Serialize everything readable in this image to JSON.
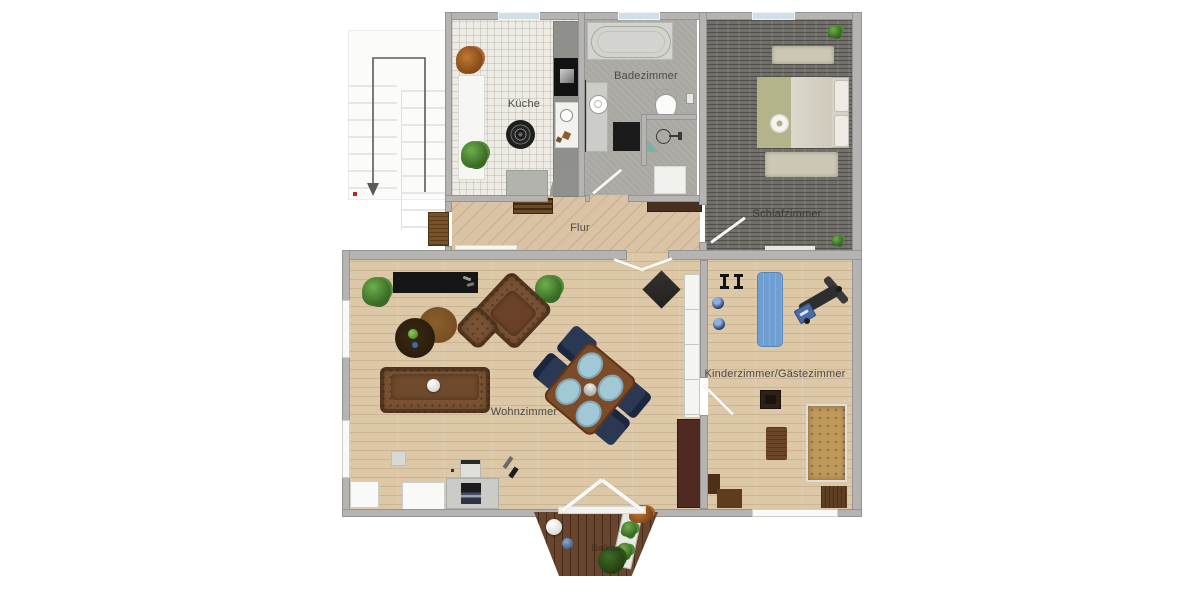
{
  "rooms": {
    "kueche": {
      "label": "Küche"
    },
    "badezimmer": {
      "label": "Badezimmer"
    },
    "schlafzimmer": {
      "label": "Schlafzimmer"
    },
    "flur": {
      "label": "Flur"
    },
    "wohnzimmer": {
      "label": "Wohnzimmer"
    },
    "kinderzimmer": {
      "label": "Kinderzimmer/Gästezimmer"
    },
    "balkon": {
      "label": "Balkon"
    }
  },
  "colors": {
    "wall": "#b5b4b2",
    "wood_floor": "#dcc7a7",
    "tile_floor": "#edebe4",
    "bath_floor": "#a9a8a3",
    "bedroom_floor": "#716f69",
    "balcony_wood": "#6a452d",
    "window_glass": "#cfe0e8",
    "leather_brown": "#7b5334",
    "dining_chair_navy": "#2a3854",
    "exercise_mat_blue": "#6f9fd2",
    "stairs_marker_red": "#c22222"
  }
}
